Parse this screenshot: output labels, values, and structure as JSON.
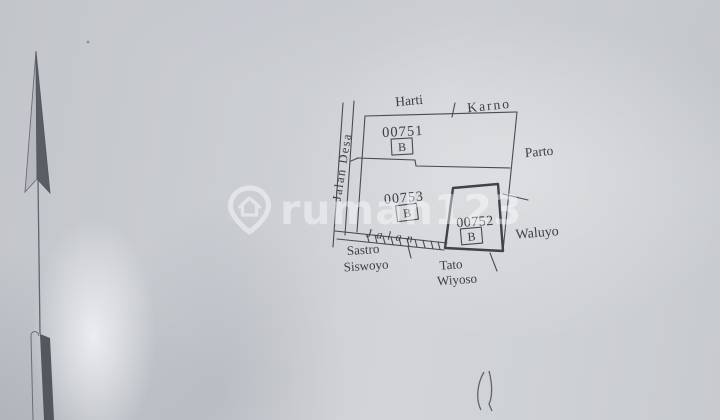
{
  "watermark": {
    "brand": "rumah123",
    "icon": "map-pin-home-icon",
    "color": "#ffffff"
  },
  "compass": {
    "icon": "north-arrow-icon"
  },
  "pen_mark": {
    "icon": "pen-squiggle-mark"
  },
  "map": {
    "ink_color": "#3b3f45",
    "roads": {
      "left_road_label": "Jalan Desa",
      "bottom_road_label": "Jalan"
    },
    "parcels": [
      {
        "number": "00751",
        "class_code": "B"
      },
      {
        "number": "00753",
        "class_code": "B"
      },
      {
        "number": "00752",
        "class_code": "B"
      }
    ],
    "neighbors": {
      "top_left": "Harti",
      "top_right": "Karno",
      "right_upper": "Parto",
      "right_lower": "Waluyo",
      "bottom_left_line1": "Sastro",
      "bottom_left_line2": "Siswoyo",
      "bottom_center_line1": "Tato",
      "bottom_center_line2": "Wiyoso"
    }
  }
}
